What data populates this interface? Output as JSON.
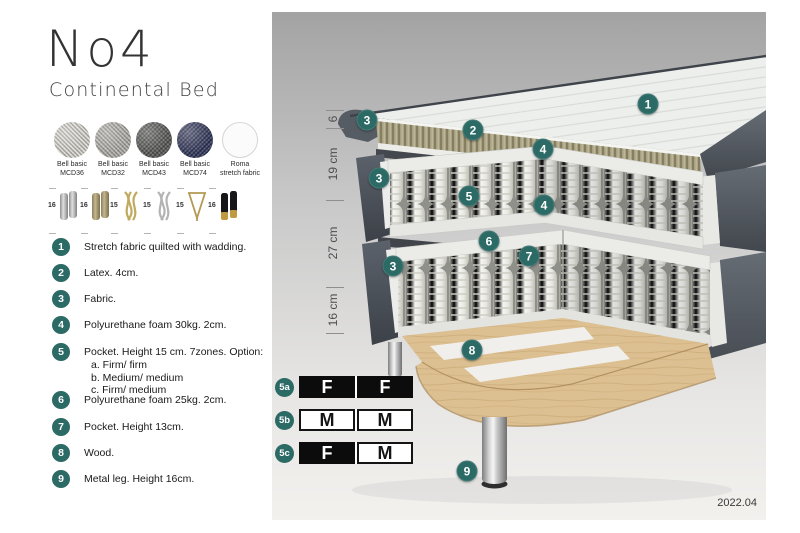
{
  "accent_teal": "#2c6a66",
  "title": {
    "main": "No4",
    "sub": "Continental Bed"
  },
  "fabrics": [
    {
      "line1": "Bell basic",
      "line2": "MCD36",
      "color": "#d9d7d0"
    },
    {
      "line1": "Bell basic",
      "line2": "MCD32",
      "color": "#b3b1ab"
    },
    {
      "line1": "Bell basic",
      "line2": "MCD43",
      "color": "#585856"
    },
    {
      "line1": "Bell basic",
      "line2": "MCD74",
      "color": "#31365a"
    },
    {
      "line1": "Roma",
      "line2": "stretch fabric",
      "color": "#fbfbfb"
    }
  ],
  "legs": [
    {
      "height": "16",
      "style": "cylinder-silver"
    },
    {
      "height": "16",
      "style": "cylinder-brass"
    },
    {
      "height": "15",
      "style": "wave-gold"
    },
    {
      "height": "15",
      "style": "wave-silver"
    },
    {
      "height": "15",
      "style": "hairpin-gold"
    },
    {
      "height": "16",
      "style": "cylinder-black-gold"
    }
  ],
  "parts": [
    {
      "num": "1",
      "text": "Stretch fabric quilted with wadding."
    },
    {
      "num": "2",
      "text": "Latex. 4cm."
    },
    {
      "num": "3",
      "text": "Fabric."
    },
    {
      "num": "4",
      "text": "Polyurethane foam 30kg. 2cm."
    },
    {
      "num": "5",
      "text": "Pocket. Height 15 cm. 7zones. Option:",
      "options": [
        "a. Firm/ firm",
        "b. Medium/ medium",
        "c. Firm/ medium"
      ]
    },
    {
      "num": "6",
      "text": "Polyurethane foam 25kg. 2cm."
    },
    {
      "num": "7",
      "text": "Pocket. Height 13cm."
    },
    {
      "num": "8",
      "text": "Wood."
    },
    {
      "num": "9",
      "text": "Metal leg. Height 16cm."
    }
  ],
  "measurements": [
    "6",
    "19 cm",
    "27 cm",
    "16 cm"
  ],
  "diagram": {
    "callouts": [
      {
        "num": "1"
      },
      {
        "num": "2"
      },
      {
        "num": "3"
      },
      {
        "num": "3"
      },
      {
        "num": "3"
      },
      {
        "num": "4"
      },
      {
        "num": "4"
      },
      {
        "num": "5"
      },
      {
        "num": "6"
      },
      {
        "num": "7"
      },
      {
        "num": "8"
      },
      {
        "num": "9"
      }
    ]
  },
  "firmness": {
    "rows": [
      {
        "label": "5a",
        "cells": [
          {
            "letter": "F",
            "bg": "black"
          },
          {
            "letter": "F",
            "bg": "black"
          }
        ]
      },
      {
        "label": "5b",
        "cells": [
          {
            "letter": "M",
            "bg": "white"
          },
          {
            "letter": "M",
            "bg": "white"
          }
        ]
      },
      {
        "label": "5c",
        "cells": [
          {
            "letter": "F",
            "bg": "black"
          },
          {
            "letter": "M",
            "bg": "white"
          }
        ]
      }
    ]
  },
  "footer": {
    "date": "2022.04"
  }
}
